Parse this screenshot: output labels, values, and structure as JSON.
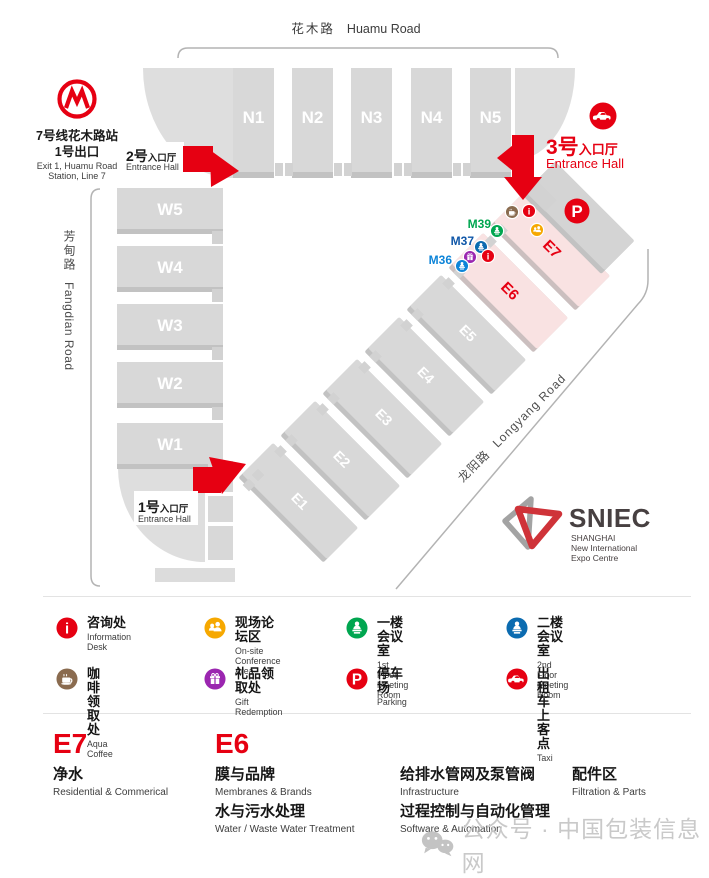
{
  "map": {
    "roads": {
      "huamu_cn": "花木路",
      "huamu_en": "Huamu Road",
      "fangdian_cn": "芳甸路",
      "fangdian_en": "Fangdian Road",
      "longyang_cn": "龙阳路",
      "longyang_en": "Longyang Road"
    },
    "metro": {
      "line1_cn": "7号线花木路站",
      "line2_cn": "1号出口",
      "line1_en": "Exit 1, Huamu Road",
      "line2_en": "Station, Line 7"
    },
    "entrances": {
      "e2": {
        "num": "2号",
        "suffix": "入口厅",
        "en": "Entrance Hall"
      },
      "e3": {
        "num": "3号",
        "suffix": "入口厅",
        "en": "Entrance Hall"
      },
      "e1": {
        "num": "1号",
        "suffix": "入口厅",
        "en": "Entrance Hall"
      }
    },
    "halls": {
      "n": [
        "N1",
        "N2",
        "N3",
        "N4",
        "N5"
      ],
      "w": [
        "W5",
        "W4",
        "W3",
        "W2",
        "W1"
      ],
      "e": [
        "E1",
        "E2",
        "E3",
        "E4",
        "E5",
        "E6",
        "E7"
      ]
    },
    "gates": {
      "m36": "M36",
      "m37": "M37",
      "m39": "M39"
    },
    "parking_badge": "P",
    "logo": {
      "name": "SNIEC",
      "sub1": "SHANGHAI",
      "sub2": "New International",
      "sub3": "Expo Centre"
    }
  },
  "legend": {
    "items": [
      {
        "icon": "information-icon",
        "color": "#e60012",
        "cn": "咨询处",
        "en": "Information Desk"
      },
      {
        "icon": "conference-icon",
        "color": "#f6a800",
        "cn": "现场论坛区",
        "en": "On-site Conference Area"
      },
      {
        "icon": "meeting-1f-icon",
        "color": "#00a650",
        "cn": "一楼会议室",
        "en": "1st Floor Meeting Room"
      },
      {
        "icon": "meeting-2f-icon",
        "color": "#0b6bb0",
        "cn": "二楼会议室",
        "en": "2nd Floor Meeting Room"
      },
      {
        "icon": "coffee-icon",
        "color": "#8a6b4f",
        "cn": "咖啡领取处",
        "en": "Aqua Coffee"
      },
      {
        "icon": "gift-icon",
        "color": "#9b26b0",
        "cn": "礼品领取处",
        "en": "Gift Redemption"
      },
      {
        "icon": "parking-icon",
        "color": "#e60012",
        "cn": "停车场",
        "en": "Parking"
      },
      {
        "icon": "taxi-icon",
        "color": "#e60012",
        "cn": "出租车上客点",
        "en": "Taxi"
      }
    ]
  },
  "sections": {
    "e7": {
      "code": "E7",
      "items": [
        {
          "cn": "净水",
          "en": "Residential & Commerical"
        }
      ]
    },
    "e6": {
      "code": "E6",
      "items": [
        {
          "cn": "膜与品牌",
          "en": "Membranes & Brands"
        },
        {
          "cn": "水与污水处理",
          "en": "Water / Waste Water Treatment"
        }
      ]
    },
    "col3": {
      "items": [
        {
          "cn": "给排水管网及泵管阀",
          "en": "Infrastructure"
        },
        {
          "cn": "过程控制与自动化管理",
          "en": "Software & Automation"
        }
      ]
    },
    "col4": {
      "items": [
        {
          "cn": "配件区",
          "en": "Filtration & Parts"
        }
      ]
    }
  },
  "watermark": {
    "text": "公众号 · 中国包装信息网"
  },
  "colors": {
    "accent_red": "#e60012",
    "hall_gray": "#d8d8d8",
    "hall_pink": "#f9e2e2",
    "gate_green": "#00a650",
    "gate_blue": "#0b6bb0",
    "road_line": "#b3b3b3"
  }
}
